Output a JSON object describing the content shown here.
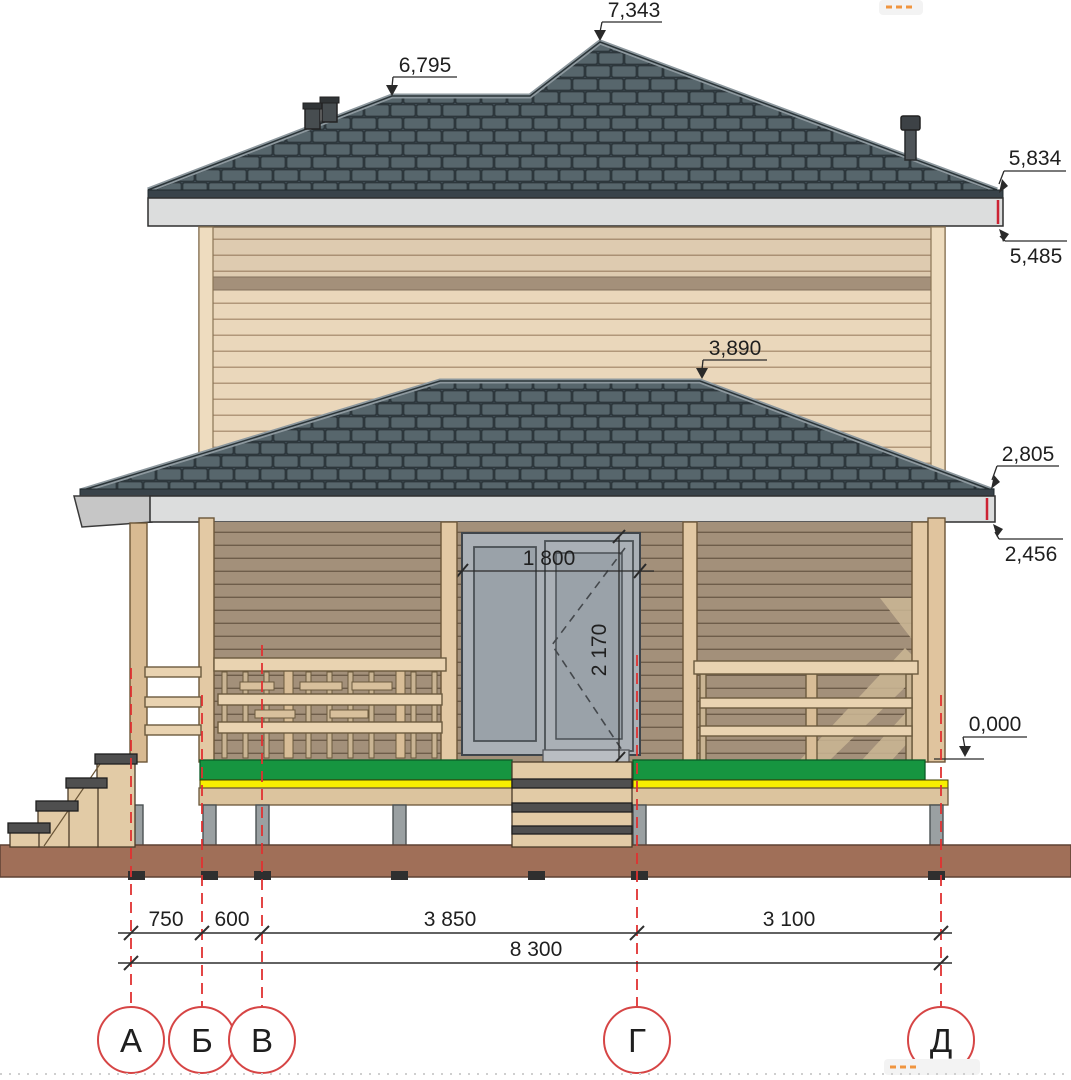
{
  "drawing": {
    "title": "house-front-elevation",
    "elevations": {
      "ridge_main": "7,343",
      "ridge_secondary": "6,795",
      "main_eave_top": "5,834",
      "main_eave_bottom": "5,485",
      "porch_ridge": "3,890",
      "porch_eave_top": "2,805",
      "porch_eave_bottom": "2,456",
      "floor_zero": "0,000"
    },
    "door": {
      "width": "1 800",
      "height": "2 170"
    },
    "axes": [
      "А",
      "Б",
      "В",
      "Г",
      "Д"
    ],
    "spans": [
      "750",
      "600",
      "3 850",
      "3 100"
    ],
    "overall": "8 300",
    "colors": {
      "roof_tile": "#57666c",
      "wall_siding": "#ead7bb",
      "deck_accent_green": "#169540",
      "deck_accent_yellow": "#f8ee00",
      "axis_red": "#e03131",
      "ground_brown": "#a06f58"
    }
  }
}
